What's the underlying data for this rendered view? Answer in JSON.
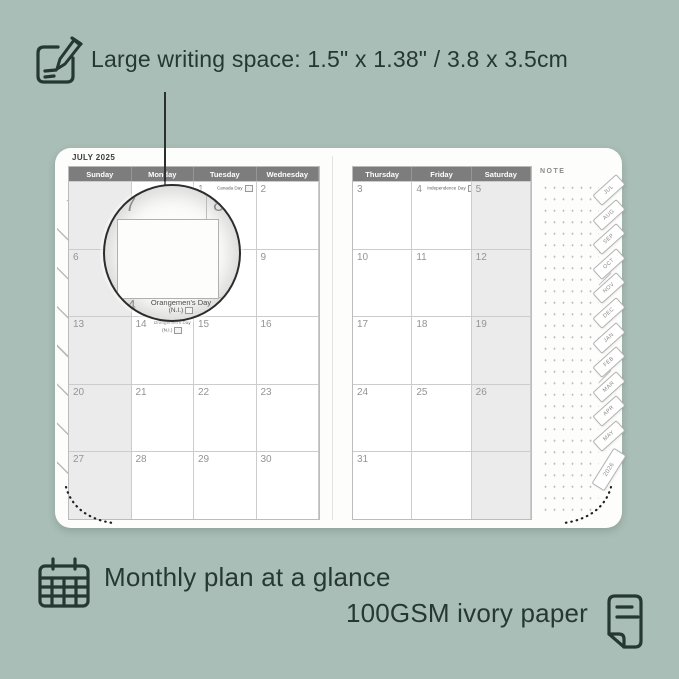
{
  "colors": {
    "background": "#a9beb7",
    "ink": "#263832",
    "page": "#fdfdfc",
    "header_bg": "#7d7d7d",
    "header_text": "#ffffff",
    "shaded_cell": "#ebebeb",
    "grid_line": "#cccccc",
    "date_text": "#949494"
  },
  "top_annotation": {
    "icon": "note-pencil-icon",
    "text": "Large writing space: 1.5\" x 1.38\" / 3.8 x 3.5cm"
  },
  "bottom_annotations": {
    "monthly": {
      "icon": "calendar-grid-icon",
      "text": "Monthly plan at a glance"
    },
    "paper": {
      "icon": "paper-page-icon",
      "text": "100GSM ivory paper"
    }
  },
  "planner": {
    "left_page": {
      "month_title": "JULY 2025",
      "day_headers": [
        "Sunday",
        "Monday",
        "Tuesday",
        "Wednesday"
      ],
      "shaded_column": 0,
      "weeks": [
        [
          {
            "d": ""
          },
          {
            "d": ""
          },
          {
            "d": "1",
            "holiday": [
              "Canada Day"
            ]
          },
          {
            "d": "2"
          }
        ],
        [
          {
            "d": "6"
          },
          {
            "d": "7"
          },
          {
            "d": "8"
          },
          {
            "d": "9"
          }
        ],
        [
          {
            "d": "13"
          },
          {
            "d": "14",
            "holiday": [
              "Orangemen's Day",
              "(N.I.)"
            ]
          },
          {
            "d": "15"
          },
          {
            "d": "16"
          }
        ],
        [
          {
            "d": "20"
          },
          {
            "d": "21"
          },
          {
            "d": "22"
          },
          {
            "d": "23"
          }
        ],
        [
          {
            "d": "27"
          },
          {
            "d": "28"
          },
          {
            "d": "29"
          },
          {
            "d": "30"
          }
        ]
      ]
    },
    "right_page": {
      "note_label": "NOTE",
      "day_headers": [
        "Thursday",
        "Friday",
        "Saturday"
      ],
      "shaded_column": 2,
      "weeks": [
        [
          {
            "d": "3"
          },
          {
            "d": "4",
            "holiday": [
              "Independence Day"
            ]
          },
          {
            "d": "5"
          }
        ],
        [
          {
            "d": "10"
          },
          {
            "d": "11"
          },
          {
            "d": "12"
          }
        ],
        [
          {
            "d": "17"
          },
          {
            "d": "18"
          },
          {
            "d": "19"
          }
        ],
        [
          {
            "d": "24"
          },
          {
            "d": "25"
          },
          {
            "d": "26"
          }
        ],
        [
          {
            "d": "31"
          },
          {
            "d": ""
          },
          {
            "d": ""
          }
        ]
      ]
    },
    "side_tabs": [
      {
        "label": "JUL"
      },
      {
        "label": "AUG"
      },
      {
        "label": "SEP"
      },
      {
        "label": "OCT"
      },
      {
        "label": "NOV"
      },
      {
        "label": "DEC"
      },
      {
        "label": "JAN"
      },
      {
        "label": "FEB"
      },
      {
        "label": "MAR"
      },
      {
        "label": "APR"
      },
      {
        "label": "MAY"
      },
      {
        "label": "2026",
        "wide": true
      }
    ],
    "magnifier": {
      "top_left_date": "7",
      "top_right_date": "8",
      "bottom_date": "14",
      "holiday_line1": "Orangemen's Day",
      "holiday_line2": "(N.I.)"
    }
  }
}
